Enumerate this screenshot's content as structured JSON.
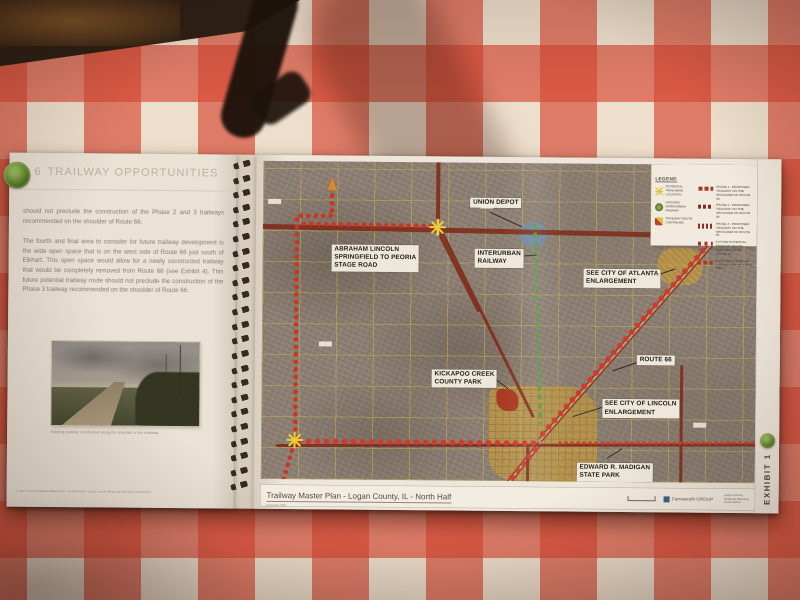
{
  "scene": {
    "description": "Spiral-bound trailway master plan report lying open on a red and white checkered tablecloth",
    "tablecloth_red": "#d74432",
    "page_color": "#ece7dd",
    "trail_dot_red": "#cf2f1e",
    "road_dark_red": "#7c2a1c",
    "railway_green": "#4da03c",
    "marker_yellow": "#e9d43a",
    "city_fill": "#d2a53a"
  },
  "left_page": {
    "section_number": "6",
    "title": "TRAILWAY OPPORTUNITIES",
    "paragraphs": [
      "should not preclude the construction of the Phase 2 and 3 trailways recommended on the shoulder of Route 66.",
      "The fourth and final area to consider for future trailway development is the wide open space that is on the west side of Route 66 just south of Elkhart.  This open space would allow for a newly constructed trailway that would be completely removed from Route 66 (see Exhibit 4).  This future potential trailway route should not preclude the construction of the Phase 3 trailway recommended on the shoulder of Route 66."
    ],
    "photo_caption": "Existing trailway constructed along the shoulder of the roadway",
    "footer_note": "Logan County Trailway Master Plan  -  Final Report  -  Logan County Regional Planning Commission"
  },
  "binding": {
    "coil_count": 23
  },
  "map_page": {
    "legend": {
      "title": "LEGEND",
      "point_items": [
        {
          "icon": "asterisk",
          "label": "POTENTIAL TRAILHEAD LOCATION"
        },
        {
          "icon": "interurban-logo",
          "label": "HISTORIC INTERURBAN RAILWAY"
        },
        {
          "icon": "direction-marker",
          "label": "TRAILWAY ROUTE CONTINUES"
        }
      ],
      "line_items": [
        {
          "label": "PHASE 1 - PROPOSED TRAILWAY ON THE SHOULDER OF ROUTE 66"
        },
        {
          "label": "PHASE 2 - PROPOSED TRAILWAY ON THE SHOULDER OF ROUTE 66"
        },
        {
          "label": "PHASE 3 - PROPOSED TRAILWAY ON THE SHOULDER OF ROUTE 66"
        },
        {
          "label": "FUTURE POTENTIAL TRAILWAY ROUTE REMOVED FROM ROUTE 66"
        },
        {
          "label": "PROPOSED TRAILWAY CONNECTION TO STATE PARK"
        }
      ]
    },
    "labels": [
      {
        "text": "UNION DEPOT",
        "x": 42,
        "y": 11
      },
      {
        "text": "ABRAHAM LINCOLN\nSPRINGFIELD TO PEORIA\nSTAGE ROAD",
        "x": 14,
        "y": 26
      },
      {
        "text": "INTERURBAN\nRAILWAY",
        "x": 43,
        "y": 27
      },
      {
        "text": "SEE CITY OF ATLANTA\nENLARGEMENT",
        "x": 65,
        "y": 33
      },
      {
        "text": "ROUTE 66",
        "x": 76,
        "y": 60
      },
      {
        "text": "KICKAPOO CREEK\nCOUNTY PARK",
        "x": 34.5,
        "y": 65
      },
      {
        "text": "SEE CITY OF LINCOLN\nENLARGEMENT",
        "x": 69,
        "y": 74
      },
      {
        "text": "EDWARD R. MADIGAN\nSTATE PARK",
        "x": 64,
        "y": 94
      }
    ],
    "roads": [
      {
        "x1": -1,
        "y1": 20.5,
        "x2": 101,
        "y2": 22.5,
        "w": 4.5
      },
      {
        "x1": 35.5,
        "y1": -1,
        "x2": 35.5,
        "y2": 21.5,
        "w": 4
      },
      {
        "x1": 35.5,
        "y1": 21.5,
        "x2": 44,
        "y2": 47,
        "w": 2.5
      },
      {
        "x1": 98,
        "y1": 12,
        "x2": 56.5,
        "y2": 87,
        "w": 5,
        "r66": true
      },
      {
        "x1": 56.5,
        "y1": 88,
        "x2": 46,
        "y2": 109,
        "w": 5,
        "r66": true
      },
      {
        "x1": 55,
        "y1": 80,
        "x2": 36,
        "y2": 21.5,
        "w": 2.5
      },
      {
        "x1": 3,
        "y1": 89.5,
        "x2": 101,
        "y2": 88,
        "w": 3
      },
      {
        "x1": 85,
        "y1": 63,
        "x2": 85,
        "y2": 102,
        "w": 3
      },
      {
        "x1": 54,
        "y1": 89,
        "x2": 54,
        "y2": 103,
        "w": 2.5
      }
    ],
    "trails": [
      {
        "x1": 14,
        "y1": 9.5,
        "x2": 14,
        "y2": 17
      },
      {
        "x1": 6.8,
        "y1": 17,
        "x2": 14.4,
        "y2": 17
      },
      {
        "x1": 6.8,
        "y1": 17,
        "x2": 6.8,
        "y2": 87
      },
      {
        "x1": 6.8,
        "y1": 87.5,
        "x2": 3.5,
        "y2": 106
      },
      {
        "x1": 7.5,
        "y1": 19.8,
        "x2": 35,
        "y2": 20.2
      },
      {
        "x1": 6.8,
        "y1": 88,
        "x2": 56,
        "y2": 88,
        "cls": "dots dots-lg"
      },
      {
        "x1": 98,
        "y1": 11,
        "x2": 56.5,
        "y2": 86,
        "cls": "dots dots-lg"
      },
      {
        "x1": 56,
        "y1": 89,
        "x2": 47,
        "y2": 106,
        "cls": "dots dots-lg"
      },
      {
        "x1": 60,
        "y1": 88,
        "x2": 101,
        "y2": 87.5,
        "cls": "dots dots-sm"
      }
    ],
    "green_line": {
      "x1": 55,
      "y1": 19,
      "x2": 56.5,
      "y2": 82,
      "w": 3
    },
    "leaders": [
      {
        "x1": 46,
        "y1": 15.5,
        "x2": 52.5,
        "y2": 20
      },
      {
        "x1": 51,
        "y1": 29.5,
        "x2": 55.5,
        "y2": 29
      },
      {
        "x1": 79,
        "y1": 35.5,
        "x2": 83.5,
        "y2": 33
      },
      {
        "x1": 76.5,
        "y1": 62,
        "x2": 71,
        "y2": 65
      },
      {
        "x1": 46,
        "y1": 66.5,
        "x2": 50,
        "y2": 71
      },
      {
        "x1": 69,
        "y1": 76.5,
        "x2": 63,
        "y2": 79.5
      },
      {
        "x1": 70,
        "y1": 92.5,
        "x2": 73,
        "y2": 89.5
      },
      {
        "x1": 26.5,
        "y1": 31,
        "x2": 29,
        "y2": 34
      }
    ],
    "markers": [
      {
        "type": "asterisk",
        "x": 35.4,
        "y": 20.3
      },
      {
        "type": "asterisk",
        "x": 6.8,
        "y": 87.6
      },
      {
        "type": "asterisk",
        "x": 86.3,
        "y": 21.5
      },
      {
        "type": "arrow",
        "x": 14,
        "y": 7,
        "angle": 0
      },
      {
        "type": "arrow",
        "x": 97,
        "y": 12.5,
        "angle": 30
      },
      {
        "type": "arrow",
        "x": 47.8,
        "y": 103,
        "angle": 205
      }
    ],
    "chips": [
      {
        "x": 1,
        "y": 12
      },
      {
        "x": 44,
        "y": 12.8
      },
      {
        "x": 87.5,
        "y": 81
      },
      {
        "x": 11.5,
        "y": 56.5
      }
    ],
    "title_bar": {
      "title": "Trailway Master Plan - Logan County, IL - North Half",
      "subtext": "December 2011",
      "firm": "Farnsworth GROUP",
      "agency": "Logan County\nRegional Planning\nCommission"
    },
    "exhibit_label": "EXHIBIT 1"
  }
}
